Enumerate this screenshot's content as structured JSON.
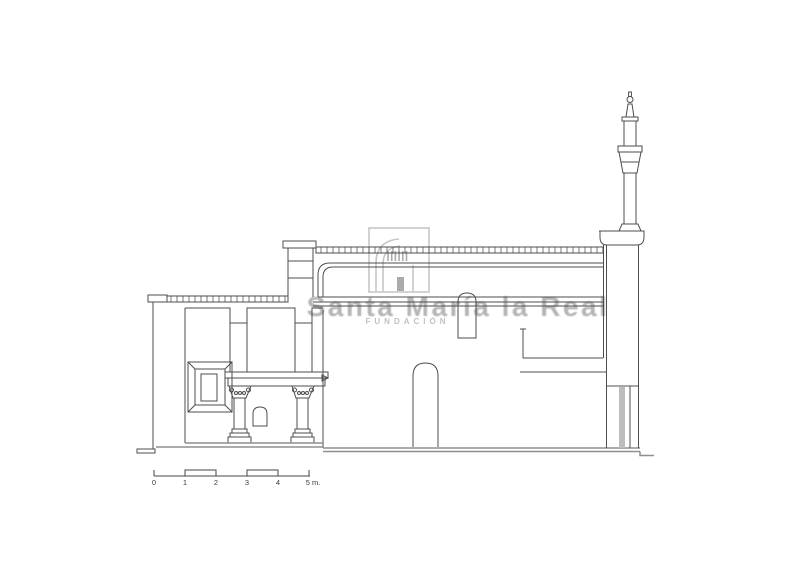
{
  "watermark": {
    "title": "Santa María la Real",
    "subtitle": "FUNDACIÓN",
    "logo_icon": "santa-maria-la-real-arch-logo",
    "text_color": "#b6b6b6"
  },
  "drawing": {
    "line_color": "#4d4d4d",
    "muted_line_color": "#8f8f8f",
    "background_color": "#ffffff"
  },
  "scale_bar": {
    "unit_label": "m.",
    "labels": [
      "0",
      "1",
      "2",
      "3",
      "4",
      "5 m."
    ]
  }
}
